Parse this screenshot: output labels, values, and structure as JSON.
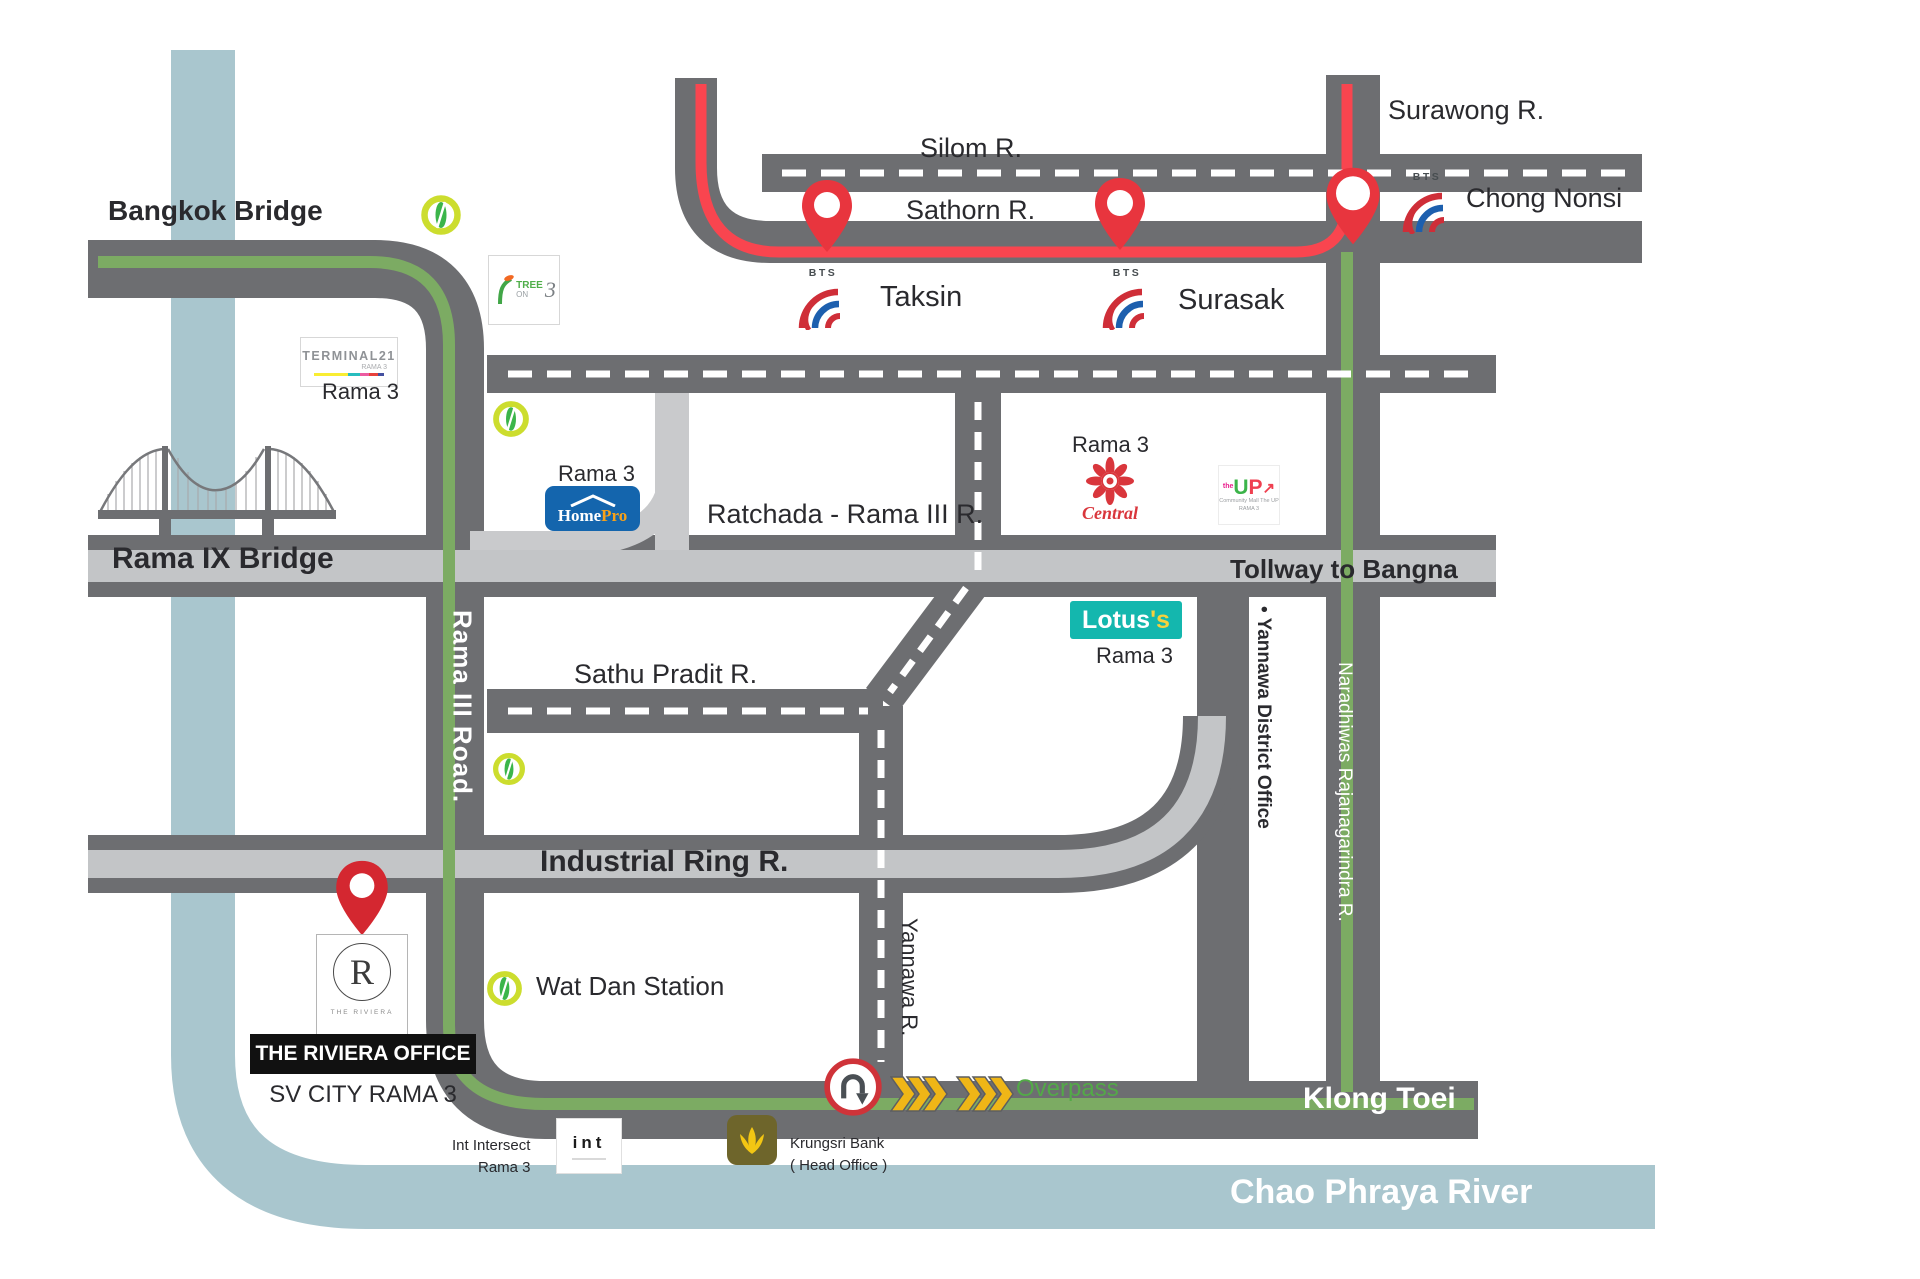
{
  "map": {
    "labels": {
      "bangkok_bridge": "Bangkok Bridge",
      "silom": "Silom R.",
      "sathorn": "Sathorn R.",
      "surawong": "Surawong R.",
      "chong_nonsi": "Chong Nonsi",
      "taksin": "Taksin",
      "surasak": "Surasak",
      "rama3": "Rama 3",
      "ratchada": "Ratchada - Rama III R.",
      "tollway": "Tollway to Bangna",
      "rama_ix": "Rama IX Bridge",
      "sathu": "Sathu Pradit R.",
      "rama_iii_road": "Rama III Road.",
      "naradhiwas": "Naradhiwas Rajanagarindra R.",
      "yannawa_district": "•  Yannawa District Office",
      "yannawa_r": "Yannawa R.",
      "industrial": "Industrial Ring R.",
      "wat_dan": "Wat Dan Station",
      "riviera_office": "THE RIVIERA OFFICE",
      "sv_city": "SV CITY RAMA 3",
      "overpass": "Overpass",
      "klong_toei": "Klong Toei",
      "chao_phraya": "Chao Phraya River",
      "int_name": "Int Intersect",
      "krungsri_name": "Krungsri Bank",
      "krungsri_sub": "( Head Office )"
    },
    "logos": {
      "terminal21": {
        "name": "TERMINAL21",
        "sub": "RAMA 3"
      },
      "tree": {
        "word1": "TREE",
        "word2": "ON",
        "num": "3"
      },
      "homepro": {
        "home": "Home",
        "pro": "Pro"
      },
      "central": {
        "script": "Central"
      },
      "up": {
        "the": "the",
        "u": "U",
        "p": "P",
        "arrow": "↗",
        "cap1": "Community Mall The UP",
        "cap2": "RAMA 3"
      },
      "lotus": {
        "name": "Lotus",
        "s": "'s"
      },
      "riviera": {
        "letter": "R",
        "sub": "THE RIVIERA"
      },
      "bts": {
        "label": "BTS"
      },
      "intbox": {
        "name": "int"
      }
    },
    "colors": {
      "road_dark": "#6d6e71",
      "road_light": "#c3c5c7",
      "river": "#a9c6ce",
      "green_line": "#7cab63",
      "red_line": "#f9454f",
      "brt_green": "#3bb54a",
      "brt_ring": "#ccdd2e",
      "pin_red": "#e8353e",
      "lotus_teal": "#14b7ae",
      "homepro_blue": "#1465ad",
      "central_red": "#d9363c",
      "overpass_green": "#53a948",
      "chevron_yellow": "#efb617",
      "krungsri_olive": "#6e652b",
      "krungsri_yellow": "#f3c613"
    }
  }
}
